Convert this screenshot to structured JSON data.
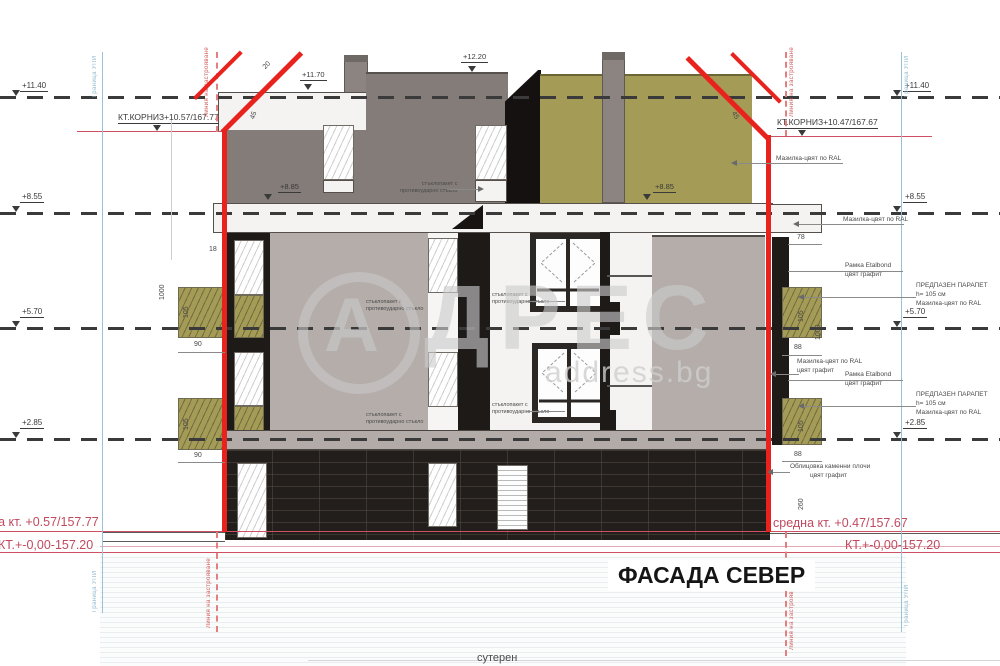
{
  "sheet": {
    "title": "ФАСАДА СЕВЕР",
    "basement_label": "сутерен"
  },
  "watermark": {
    "circle_letter": "А",
    "letters": "ДРЕС",
    "site": "address.bg"
  },
  "levels": {
    "left": [
      "+11.40",
      "+8.55",
      "+5.70",
      "+2.85"
    ],
    "right": [
      "+11.40",
      "+8.55",
      "+5.70",
      "+2.85"
    ],
    "roof_left": "+11.70",
    "roof_center": "+12.20",
    "attic_left": "+8.85",
    "attic_right": "+8.85"
  },
  "cornice": {
    "left": "КТ.КОРНИЗ+10.57/167.77",
    "right": "КТ.КОРНИЗ+10.47/167.67"
  },
  "ground": {
    "avg_left": "средна кт. +0.57/157.77",
    "avg_right": "средна кт. +0.47/157.67",
    "zero_left": "КТ.+-0,00-157.20",
    "zero_right": "КТ.+-0,00-157.20"
  },
  "boundaries": {
    "upi": "Граница УПИ",
    "building_line": "Линия на застрояване"
  },
  "dims": {
    "t18": "18",
    "t20": "20",
    "slope_l": "45",
    "slope_r": "45",
    "l105_1": "105",
    "l90_1": "90",
    "l105_2": "105",
    "l90_2": "90",
    "l1000": "1000",
    "r78": "78",
    "r105_1": "105",
    "r88_1": "88",
    "r1000": "1000",
    "r105_2": "105",
    "r88_2": "88",
    "r260": "260"
  },
  "notes": {
    "plaster": "Мазилка-цвят по RAL",
    "plaster_color2": "цвят графит",
    "frame_l1": "Рамка Etalbond",
    "frame_l2": "цвят графит",
    "parapet_l1": "ПРЕДПАЗЕН ПАРАПЕТ",
    "parapet_l2": "h= 105 см",
    "parapet_l3": "Мазилка-цвят по RAL",
    "cladding_l1": "Облицовка каменни плочи",
    "cladding_l2": "цвят графит",
    "window_l1": "стъклопакет с",
    "window_l2": "противоударно стъкло"
  }
}
